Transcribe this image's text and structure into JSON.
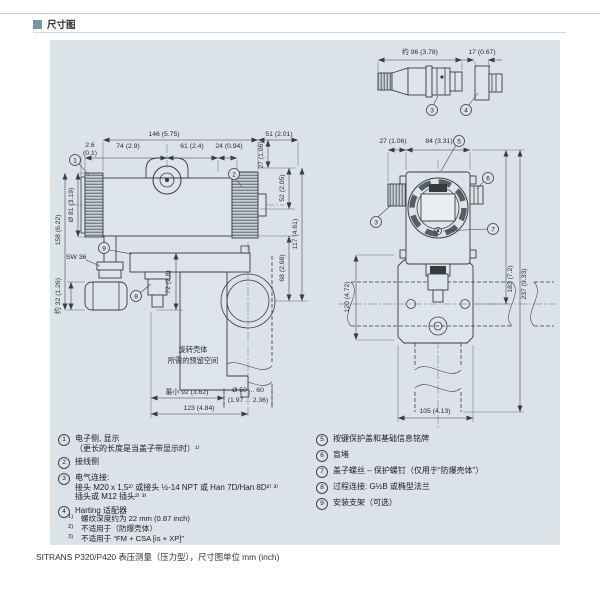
{
  "colors": {
    "accent": "#7596a7",
    "panel_bg": "#dbe2e8",
    "line": "#3c3c3c"
  },
  "page": {
    "section_title": "尺寸图",
    "caption": "SITRANS P320/P420 表压测量（压力型），尺寸图单位 mm (inch)"
  },
  "drawing_left": {
    "dims": {
      "w146": "146 (5.75)",
      "w51": "51 (2.01)",
      "w26": "2.6",
      "w26b": "(0.1)",
      "w74": "74 (2.9)",
      "w61": "61 (2.4)",
      "w24": "24 (0.94)",
      "h27": "27 (1.06)",
      "h52": "52 (2.05)",
      "h117": "117 (4.61)",
      "h68": "68 (2.68)",
      "d81": "Ø 81 (3.19)",
      "h158": "158 (6.22)",
      "h32": "约 32 (1.26)",
      "sw": "SW 36",
      "h72": "72 (2.8)",
      "min92": "最小 92 (3.62)",
      "pipe_d": "Ø 50 ... 60",
      "pipe_d_in": "(1.97 ... 2.36)",
      "w123": "123 (4.84)"
    },
    "note_line1": "旋转壳体",
    "note_line2": "所需的预留空间",
    "callouts": {
      "c1": "1",
      "c2": "2",
      "c8": "8",
      "c9": "9"
    }
  },
  "drawing_right": {
    "dims": {
      "w27": "27 (1.06)",
      "w84": "84 (3.31)",
      "h183": "183 (7.2)",
      "h237": "237 (9.33)",
      "h120": "120 (4.72)",
      "w105": "105 (4.13)"
    },
    "callouts": {
      "c3": "3",
      "c5": "5",
      "c6": "6",
      "c7": "7"
    }
  },
  "drawing_connector": {
    "dims": {
      "w96": "约 96 (3.78)",
      "w17": "17 (0.67)"
    },
    "callouts": {
      "c3": "3",
      "c4": "4"
    }
  },
  "legend_left": [
    {
      "num": "1",
      "lines": [
        "电子侧, 显示",
        "（更长的长度是当盖子带显示时）¹⁾"
      ]
    },
    {
      "num": "2",
      "lines": [
        "接线侧"
      ]
    },
    {
      "num": "3",
      "lines": [
        "电气连接:",
        "接头 M20 x 1,5²⁾ 或接头 ½-14 NPT 或 Han 7D/Han 8D²⁾ ³⁾",
        "插头或 M12 插头²⁾ ³⁾"
      ]
    },
    {
      "num": "4",
      "lines": [
        "Harting 适配器"
      ]
    }
  ],
  "legend_right": [
    {
      "num": "5",
      "lines": [
        "按键保护盖和基础信息铭牌"
      ]
    },
    {
      "num": "6",
      "lines": [
        "盲堵"
      ]
    },
    {
      "num": "7",
      "lines": [
        "盖子螺丝 – 保护螺钉（仅用于“防爆壳体”）"
      ]
    },
    {
      "num": "8",
      "lines": [
        "过程连接: G½B 或椭型法兰"
      ]
    },
    {
      "num": "9",
      "lines": [
        "安装支架（可选）"
      ]
    }
  ],
  "footnotes": [
    {
      "marker": "1)",
      "text": "螺纹深度约为 22 mm (0.87 inch)"
    },
    {
      "marker": "2)",
      "text": "不适用于（防爆壳体）"
    },
    {
      "marker": "3)",
      "text": "不适用于 “FM + CSA [is + XP]”"
    }
  ]
}
